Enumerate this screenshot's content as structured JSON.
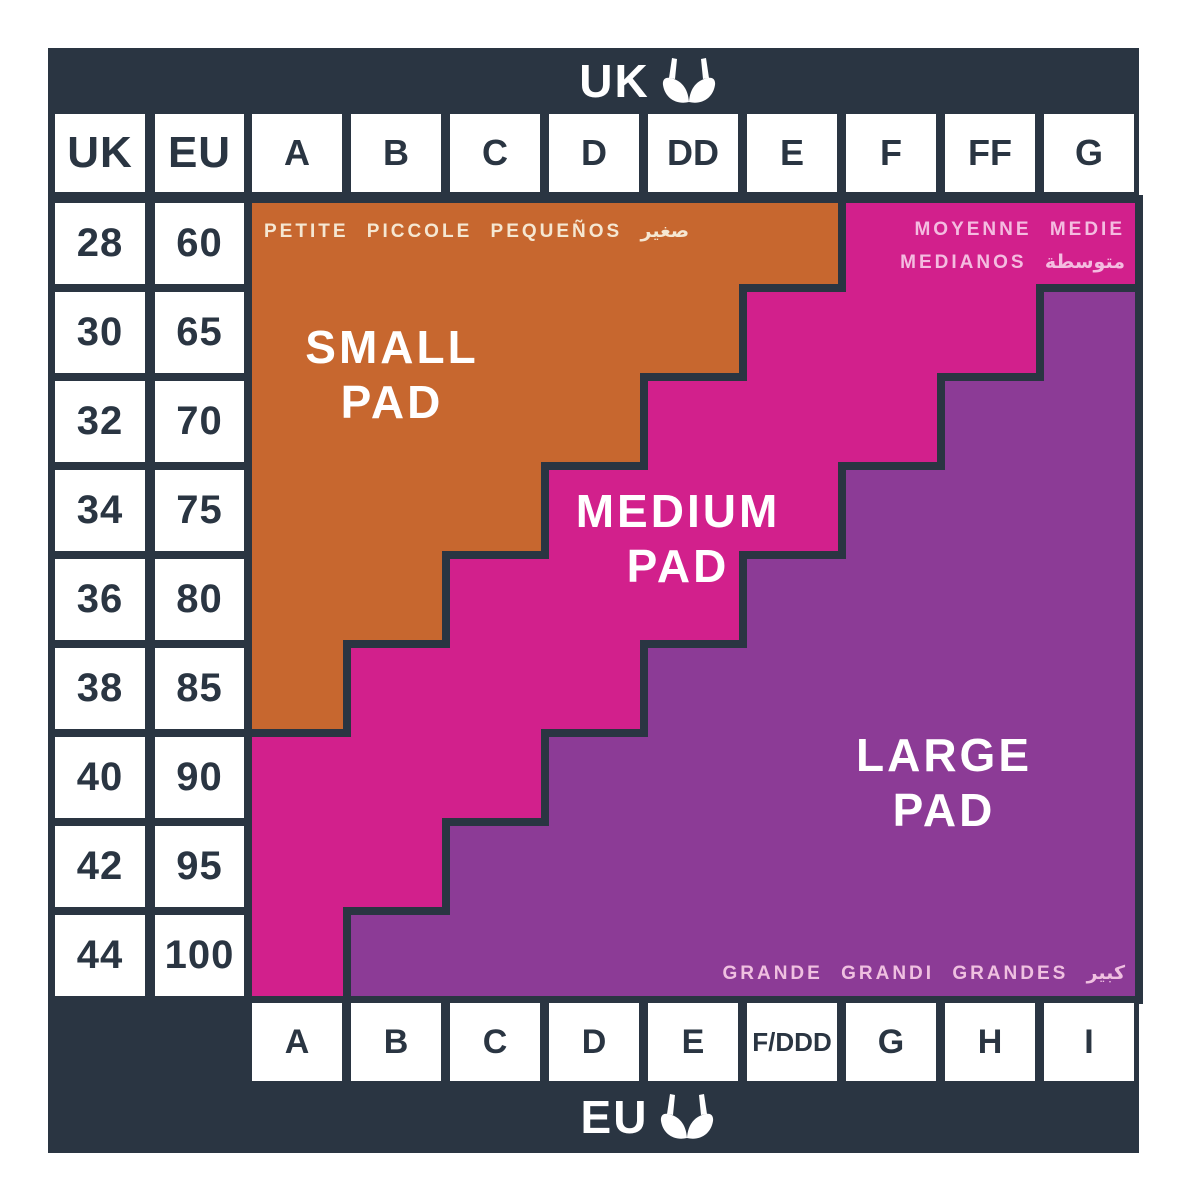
{
  "bars": {
    "top_label": "UK",
    "bottom_label": "EU"
  },
  "header": {
    "uk_band_col": "UK",
    "eu_band_col": "EU",
    "uk_cups": [
      "A",
      "B",
      "C",
      "D",
      "DD",
      "E",
      "F",
      "FF",
      "G"
    ]
  },
  "rows": [
    {
      "uk": "28",
      "eu": "60"
    },
    {
      "uk": "30",
      "eu": "65"
    },
    {
      "uk": "32",
      "eu": "70"
    },
    {
      "uk": "34",
      "eu": "75"
    },
    {
      "uk": "36",
      "eu": "80"
    },
    {
      "uk": "38",
      "eu": "85"
    },
    {
      "uk": "40",
      "eu": "90"
    },
    {
      "uk": "42",
      "eu": "95"
    },
    {
      "uk": "44",
      "eu": "100"
    }
  ],
  "eu_cups": [
    "A",
    "B",
    "C",
    "D",
    "E",
    "F/DDD",
    "G",
    "H",
    "I"
  ],
  "regions": {
    "small": {
      "line1": "SMALL",
      "line2": "PAD",
      "languages": "PETITE PICCOLE PEQUEÑOS صغير"
    },
    "medium": {
      "line1": "MEDIUM",
      "line2": "PAD",
      "languages_line1": "MOYENNE MEDIE",
      "languages_line2": "MEDIANOS متوسطة"
    },
    "large": {
      "line1": "LARGE",
      "line2": "PAD",
      "languages": "GRANDE GRANDI GRANDES كبير"
    }
  },
  "colors": {
    "navy": "#2A3542",
    "orange": "#C7672F",
    "magenta": "#D2208C",
    "purple": "#8C3B96",
    "small_label_text": "#F5E7D2",
    "medium_label_text": "#F4BCE0",
    "large_label_text": "#EFC0E0"
  },
  "chart_data": {
    "type": "table",
    "title": "UK / EU bra band and cup size chart with pad size regions",
    "uk_band_sizes": [
      28,
      30,
      32,
      34,
      36,
      38,
      40,
      42,
      44
    ],
    "eu_band_sizes": [
      60,
      65,
      70,
      75,
      80,
      85,
      90,
      95,
      100
    ],
    "uk_cup_columns": [
      "A",
      "B",
      "C",
      "D",
      "DD",
      "E",
      "F",
      "FF",
      "G"
    ],
    "eu_cup_columns": [
      "A",
      "B",
      "C",
      "D",
      "E",
      "F/DDD",
      "G",
      "H",
      "I"
    ],
    "regions": [
      "SMALL PAD",
      "MEDIUM PAD",
      "LARGE PAD"
    ],
    "row_region_spans": [
      {
        "uk_band": 28,
        "eu_band": 60,
        "small_pad_cups": [
          "A",
          "E"
        ],
        "medium_pad_cups": [
          "F",
          "G"
        ],
        "large_pad_cups": null
      },
      {
        "uk_band": 30,
        "eu_band": 65,
        "small_pad_cups": [
          "A",
          "DD"
        ],
        "medium_pad_cups": [
          "E",
          "FF"
        ],
        "large_pad_cups": [
          "G",
          "G"
        ]
      },
      {
        "uk_band": 32,
        "eu_band": 70,
        "small_pad_cups": [
          "A",
          "D"
        ],
        "medium_pad_cups": [
          "DD",
          "F"
        ],
        "large_pad_cups": [
          "FF",
          "G"
        ]
      },
      {
        "uk_band": 34,
        "eu_band": 75,
        "small_pad_cups": [
          "A",
          "C"
        ],
        "medium_pad_cups": [
          "D",
          "E"
        ],
        "large_pad_cups": [
          "F",
          "G"
        ]
      },
      {
        "uk_band": 36,
        "eu_band": 80,
        "small_pad_cups": [
          "A",
          "B"
        ],
        "medium_pad_cups": [
          "C",
          "DD"
        ],
        "large_pad_cups": [
          "E",
          "G"
        ]
      },
      {
        "uk_band": 38,
        "eu_band": 85,
        "small_pad_cups": [
          "A",
          "A"
        ],
        "medium_pad_cups": [
          "B",
          "D"
        ],
        "large_pad_cups": [
          "DD",
          "G"
        ]
      },
      {
        "uk_band": 40,
        "eu_band": 90,
        "small_pad_cups": null,
        "medium_pad_cups": [
          "A",
          "C"
        ],
        "large_pad_cups": [
          "D",
          "G"
        ]
      },
      {
        "uk_band": 42,
        "eu_band": 95,
        "small_pad_cups": null,
        "medium_pad_cups": [
          "A",
          "B"
        ],
        "large_pad_cups": [
          "C",
          "G"
        ]
      },
      {
        "uk_band": 44,
        "eu_band": 100,
        "small_pad_cups": null,
        "medium_pad_cups": [
          "A",
          "A"
        ],
        "large_pad_cups": [
          "B",
          "G"
        ]
      }
    ],
    "legend_position": "in-region labels",
    "grid": true
  }
}
